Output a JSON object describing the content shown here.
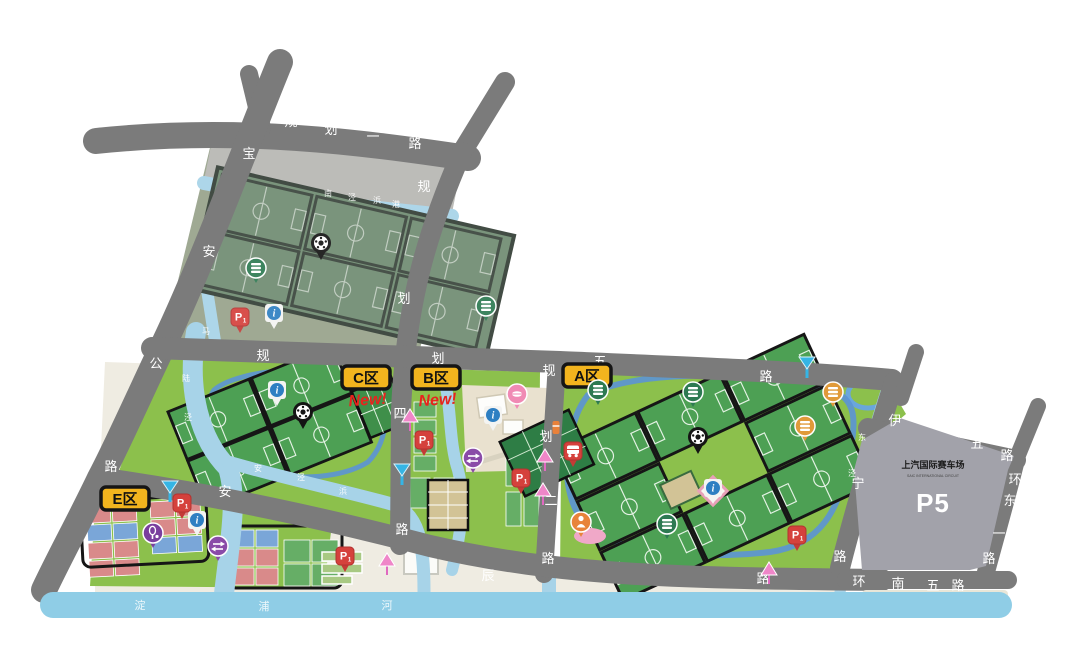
{
  "zones": {
    "A": {
      "label": "A区"
    },
    "B": {
      "label": "B区",
      "tag": "New!"
    },
    "C": {
      "label": "C区",
      "tag": "New!"
    },
    "E": {
      "label": "E区"
    }
  },
  "roads": {
    "guihua1": {
      "name": "规划一路"
    },
    "baoan": {
      "name": "宝安公路"
    },
    "guihua4": {
      "name": "规划四路"
    },
    "guihua5": {
      "name": "规划五路"
    },
    "guihua2": {
      "name": "规划二路"
    },
    "anchen": {
      "name": "安辰路"
    },
    "yining": {
      "name": "伊宁路"
    },
    "huannan5_ne": {
      "name": "环南五路"
    },
    "huandong1": {
      "name": "环东一路"
    },
    "huannan5_s": {
      "name": "环南五路"
    }
  },
  "rivers": {
    "dianpu": {
      "name": "淀浦河"
    },
    "top": {
      "name": "南泾浜港"
    },
    "ma": {
      "name": "马"
    },
    "west": {
      "name": "陆泾"
    },
    "mid": {
      "name": "安泾浜"
    },
    "east": {
      "name": "东泾"
    }
  },
  "p5": {
    "title": "上汽国际赛车场",
    "subtitle": "SAIC INTERNATIONAL CIRCUIT",
    "label": "P5"
  },
  "icons": {
    "parking": "P",
    "parking_sub": "1",
    "info": "i"
  }
}
